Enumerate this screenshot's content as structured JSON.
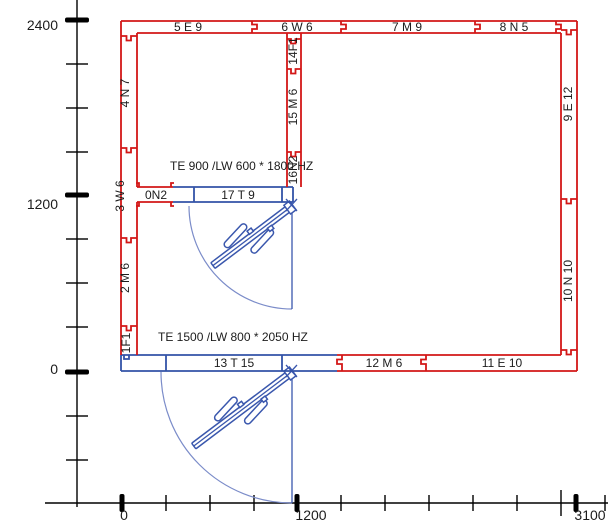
{
  "colors": {
    "wall_red": "#d31717",
    "wall_blue": "#3353a8",
    "door_blue": "#3a57ad",
    "arc_blue": "#7b8cc9",
    "text": "#1c1c1c",
    "axis": "#000000"
  },
  "y_axis": {
    "labels": [
      {
        "text": "2400"
      },
      {
        "text": "1200"
      },
      {
        "text": "0"
      }
    ]
  },
  "x_axis": {
    "labels": [
      {
        "text": "0"
      },
      {
        "text": "1200"
      },
      {
        "text": "3100"
      }
    ]
  },
  "walls": {
    "top_segments": [
      {
        "label": "5 E 9"
      },
      {
        "label": "6 W 6"
      },
      {
        "label": "7 M 9"
      },
      {
        "label": "8 N 5"
      }
    ],
    "left_segments": [
      {
        "label": "4 N 7"
      },
      {
        "label": "3 W 6"
      },
      {
        "label": "2 M 6"
      },
      {
        "label": "1F1"
      }
    ],
    "right_segments": [
      {
        "label": "9 E 12"
      },
      {
        "label": "10 N 10"
      }
    ],
    "bottom_blue_segment": {
      "label": "13 T 15"
    },
    "bottom_red_segments": [
      {
        "label": "12 M 6"
      },
      {
        "label": "11 E 10"
      }
    ],
    "interior_vertical_segments": [
      {
        "label": "14F1"
      },
      {
        "label": "15 M 6"
      },
      {
        "label": "16N2"
      }
    ],
    "interior_horizontal_segments": [
      {
        "label": "0N2"
      },
      {
        "label": "17 T 9"
      }
    ]
  },
  "doors": [
    {
      "label": "TE 900 /LW 600 * 1800 HZ"
    },
    {
      "label": "TE 1500 /LW 800 * 2050 HZ"
    }
  ]
}
